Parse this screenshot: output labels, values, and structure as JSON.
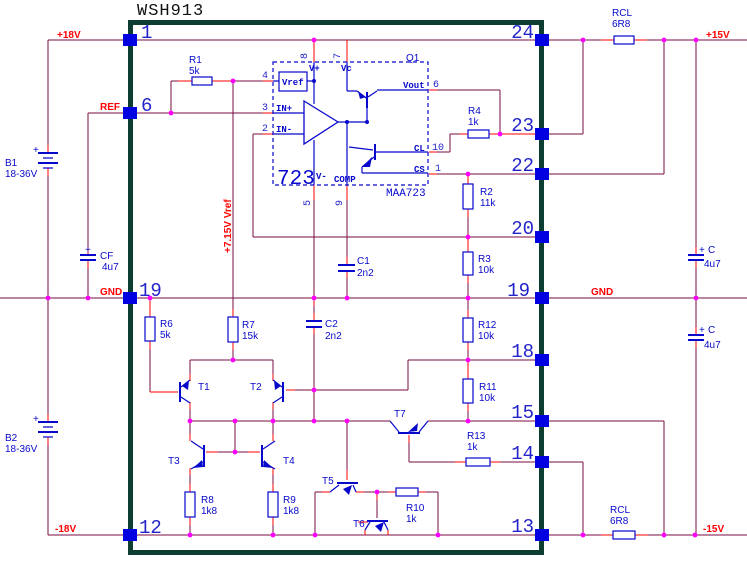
{
  "title": "WSH913",
  "nets": {
    "p18v": "+18V",
    "ref": "REF",
    "gnd_left": "GND",
    "m18v": "-18V",
    "p15v": "+15V",
    "gnd_right": "GND",
    "m15v": "-15V",
    "vref_note": "+7.15V Vref",
    "plus": "+"
  },
  "pins_left": [
    "1",
    "6",
    "19",
    "12"
  ],
  "pins_right": [
    "24",
    "23",
    "22",
    "20",
    "19",
    "18",
    "15",
    "14",
    "13"
  ],
  "ic723": {
    "big": "723",
    "part": "MAA723",
    "q1": "Q1",
    "vref": "Vref",
    "vplus": "V+",
    "vc": "Vc",
    "inp": "IN+",
    "inn": "IN-",
    "vminus": "V-",
    "comp": "COMP",
    "cl": "CL",
    "cs": "CS",
    "vout": "Vout",
    "pin8": "8",
    "pin7": "7",
    "pin4": "4",
    "pin3": "3",
    "pin2": "2",
    "pin5": "5",
    "pin9": "9",
    "pin6": "6",
    "pin10": "10",
    "pin1": "1"
  },
  "resistors": {
    "r1": {
      "name": "R1",
      "value": "5k"
    },
    "r2": {
      "name": "R2",
      "value": "11k"
    },
    "r3": {
      "name": "R3",
      "value": "10k"
    },
    "r4": {
      "name": "R4",
      "value": "1k"
    },
    "r6": {
      "name": "R6",
      "value": "5k"
    },
    "r7": {
      "name": "R7",
      "value": "15k"
    },
    "r8": {
      "name": "R8",
      "value": "1k8"
    },
    "r9": {
      "name": "R9",
      "value": "1k8"
    },
    "r10": {
      "name": "R10",
      "value": "1k"
    },
    "r11": {
      "name": "R11",
      "value": "10k"
    },
    "r12": {
      "name": "R12",
      "value": "10k"
    },
    "r13": {
      "name": "R13",
      "value": "1k"
    },
    "rcl_top": {
      "name": "RCL",
      "value": "6R8"
    },
    "rcl_bottom": {
      "name": "RCL",
      "value": "6R8"
    }
  },
  "capacitors": {
    "c1": {
      "name": "C1",
      "value": "2n2"
    },
    "c2": {
      "name": "C2",
      "value": "2n2"
    },
    "cf": {
      "name": "CF",
      "value": "4u7"
    },
    "c_right_top": {
      "name": "C",
      "value": "4u7"
    },
    "c_right_bottom": {
      "name": "C",
      "value": "4u7"
    }
  },
  "batteries": {
    "b1": {
      "name": "B1",
      "value": "18-36V"
    },
    "b2": {
      "name": "B2",
      "value": "18-36V"
    }
  },
  "transistors": {
    "t1": "T1",
    "t2": "T2",
    "t3": "T3",
    "t4": "T4",
    "t5": "T5",
    "t6": "T6",
    "t7": "T7"
  },
  "colors": {
    "wire": "#7b0d42",
    "terminal_stub": "#ff0000",
    "component": "#0808cc",
    "pin_square": "#0000e0",
    "junction": "#ff00ff",
    "module_border": "#0d3c31",
    "pin_number": "#2323cb",
    "net_label": "#ff0000"
  }
}
